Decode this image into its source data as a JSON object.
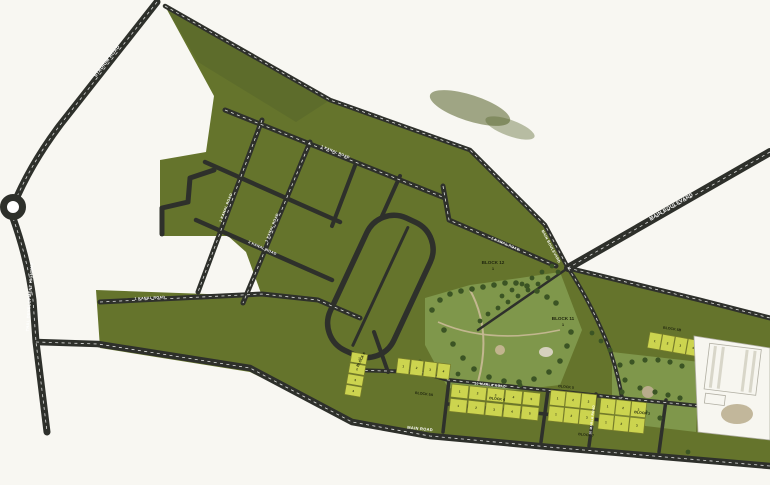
{
  "title": "Housing scheme master plan map",
  "colors": {
    "background": "#f8f7f2",
    "land": "#65742c",
    "land_dark": "#55632a",
    "road": "#2e302b",
    "road_line": "#ffffff",
    "plot_fill": "#ccd44f",
    "plot_stroke": "#777d2b",
    "park": "#7f974b",
    "tree": "#3b5424",
    "path_tan": "#c6b892",
    "building": "#f7f6f0",
    "building_shadow": "#b0aea2",
    "label_dark": "#20260f",
    "label_light": "#ffffff"
  },
  "roads": {
    "stadium": {
      "label": "STADIUM ROAD"
    },
    "thal": {
      "label": "THAL DEVELOPMENT HIGHWAY"
    },
    "boulevard": {
      "label": "MAIN BOULEVARD"
    },
    "grid1": {
      "label": "1 KANAL ROAD"
    },
    "grid2": {
      "label": "1 KANAL ROAD"
    },
    "grid3": {
      "label": "2 KANAL ROAD"
    },
    "grid4": {
      "label": "1 KANAL ROAD"
    },
    "grid5": {
      "label": "2 KANAL ROAD"
    },
    "wing": {
      "label": "1 KANAL ROAD"
    },
    "strip_top": {
      "label": "10 MARLA ROAD"
    },
    "strip_vert": {
      "label": "10 MARLA ROAD"
    },
    "bottom": {
      "label": "MAIN ROAD"
    }
  },
  "blocks": {
    "b12": {
      "label": "BLOCK 12",
      "sub": "1"
    },
    "b11": {
      "label": "BLOCK 11",
      "sub": "1"
    },
    "b6": {
      "label": "BLOCK 6"
    },
    "b5a": {
      "label": "BLOCK 5A"
    },
    "b4": {
      "label": "BLOCK 4"
    },
    "b5": {
      "label": "BLOCK 5"
    },
    "b7": {
      "label": "BLOCK 7"
    },
    "b3": {
      "label": "BLOCK 3"
    },
    "b5b": {
      "label": "BLOCK 5B"
    }
  },
  "plot_clusters": [
    {
      "id": "west-column",
      "numbers": [
        1,
        2,
        3,
        4
      ]
    },
    {
      "id": "west-row",
      "numbers": [
        1,
        2,
        3,
        4
      ]
    },
    {
      "id": "center-grid",
      "numbers": [
        1,
        2,
        3,
        4,
        5,
        1,
        2,
        3,
        4,
        5
      ]
    },
    {
      "id": "east-grid-a",
      "numbers": [
        1,
        2,
        3,
        1,
        2,
        3
      ]
    },
    {
      "id": "east-grid-b",
      "numbers": [
        1,
        2,
        3,
        1,
        2,
        3
      ]
    },
    {
      "id": "northeast-row",
      "numbers": [
        1,
        2,
        3,
        4
      ]
    }
  ]
}
